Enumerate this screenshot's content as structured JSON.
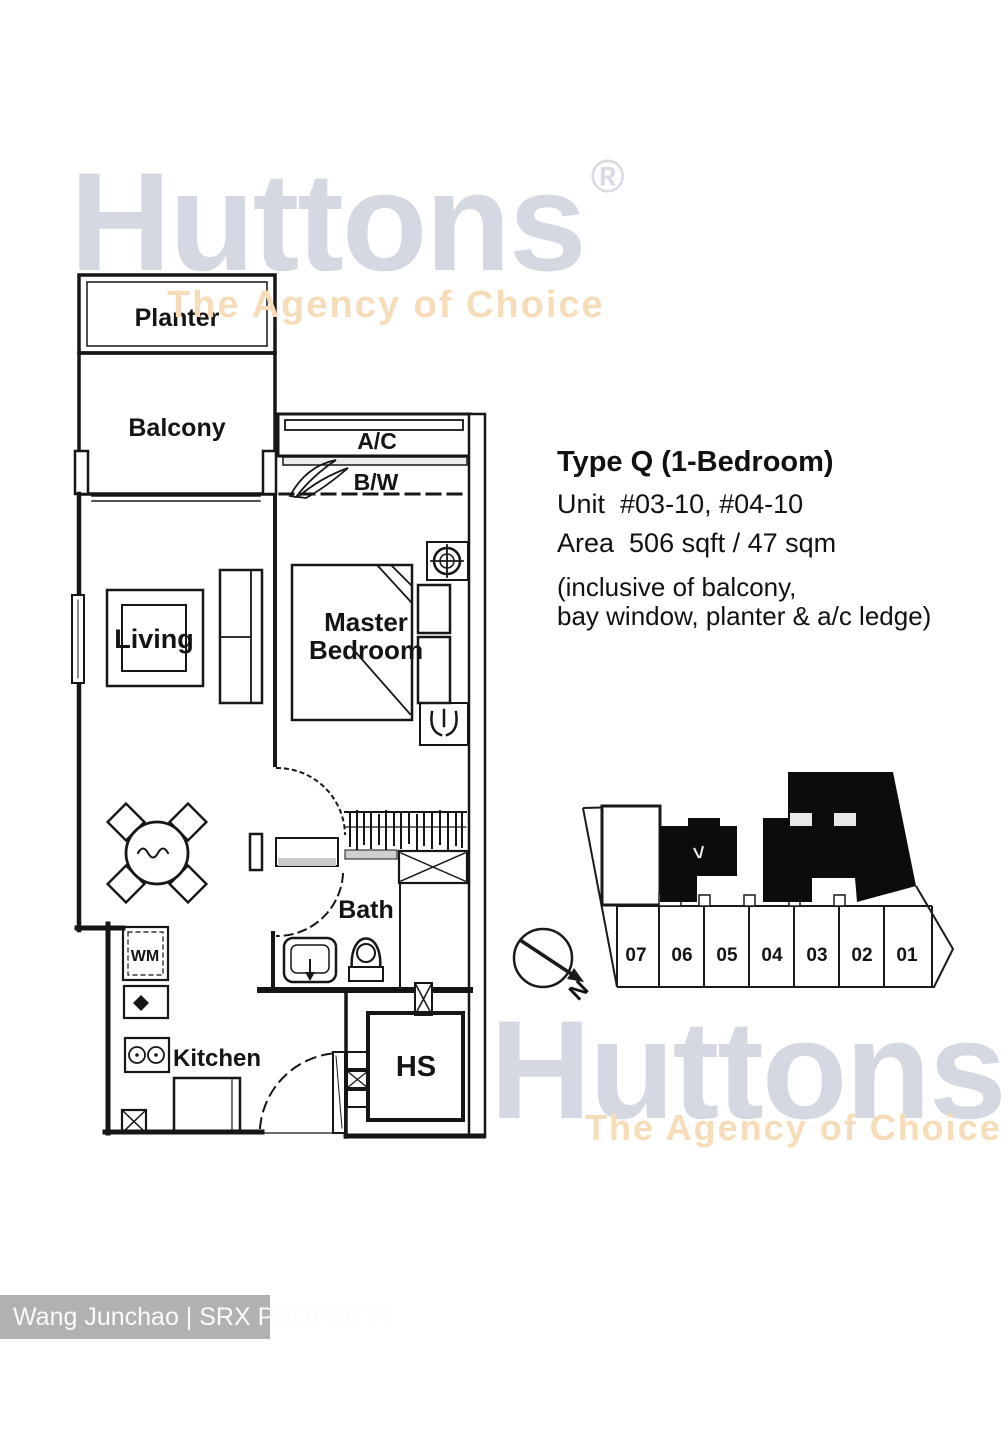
{
  "watermark_top": {
    "brand": "Huttons",
    "registered": "®",
    "tagline": "The Agency of Choice"
  },
  "watermark_bottom": {
    "brand": "Huttons",
    "tagline": "The Agency of Choice"
  },
  "info": {
    "title": "Type Q (1-Bedroom)",
    "unit_line": "Unit  #03-10, #04-10",
    "area_line": "Area  506 sqft / 47 sqm",
    "note_line_1": "(inclusive of balcony,",
    "note_line_2": "bay window, planter & a/c ledge)"
  },
  "floorplan_labels": {
    "planter": "Planter",
    "balcony": "Balcony",
    "ac_ledge": "A/C",
    "bay_window": "B/W",
    "living": "Living",
    "master_line_1": "Master",
    "master_line_2": "Bedroom",
    "bath": "Bath",
    "washing_machine": "WM",
    "kitchen": "Kitchen",
    "household_shelter": "HS"
  },
  "site_plan": {
    "stack_numbers": [
      "07",
      "06",
      "05",
      "04",
      "03",
      "02",
      "01"
    ],
    "north_label": "N"
  },
  "credit_bar": {
    "text": "Wang Junchao | SRX PROPERTY"
  },
  "colors": {
    "brand_gray": "#d4d8e1",
    "brand_orange": "#f6dcb8",
    "plan_line": "#161616",
    "site_black": "#0c0c0c",
    "credit_bg": "#b1b1b1",
    "credit_text": "#fbfbfb"
  }
}
